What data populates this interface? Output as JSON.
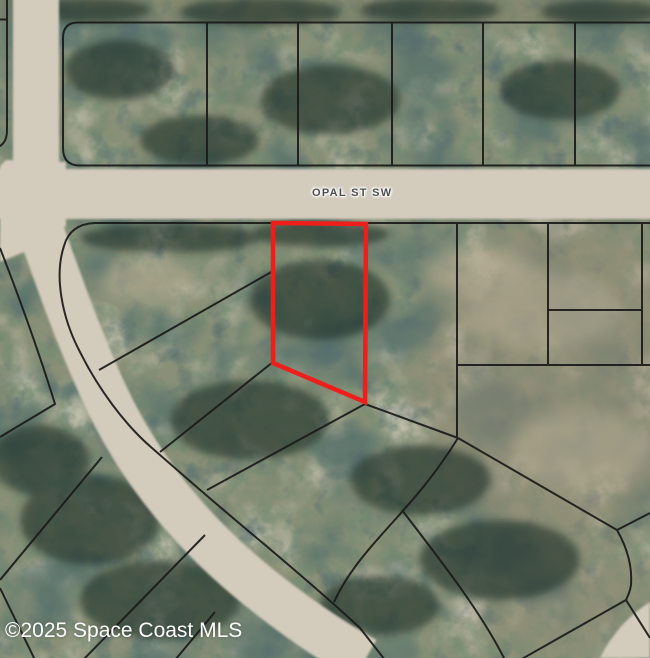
{
  "map": {
    "street_label": "OPAL ST SW",
    "watermark": "©2025 Space Coast MLS",
    "highlight_color": "#ee1f1b",
    "boundary_color": "#1a1a1a",
    "road_color": "#d3cbbc",
    "terrain_base_color": "#8a9077"
  }
}
